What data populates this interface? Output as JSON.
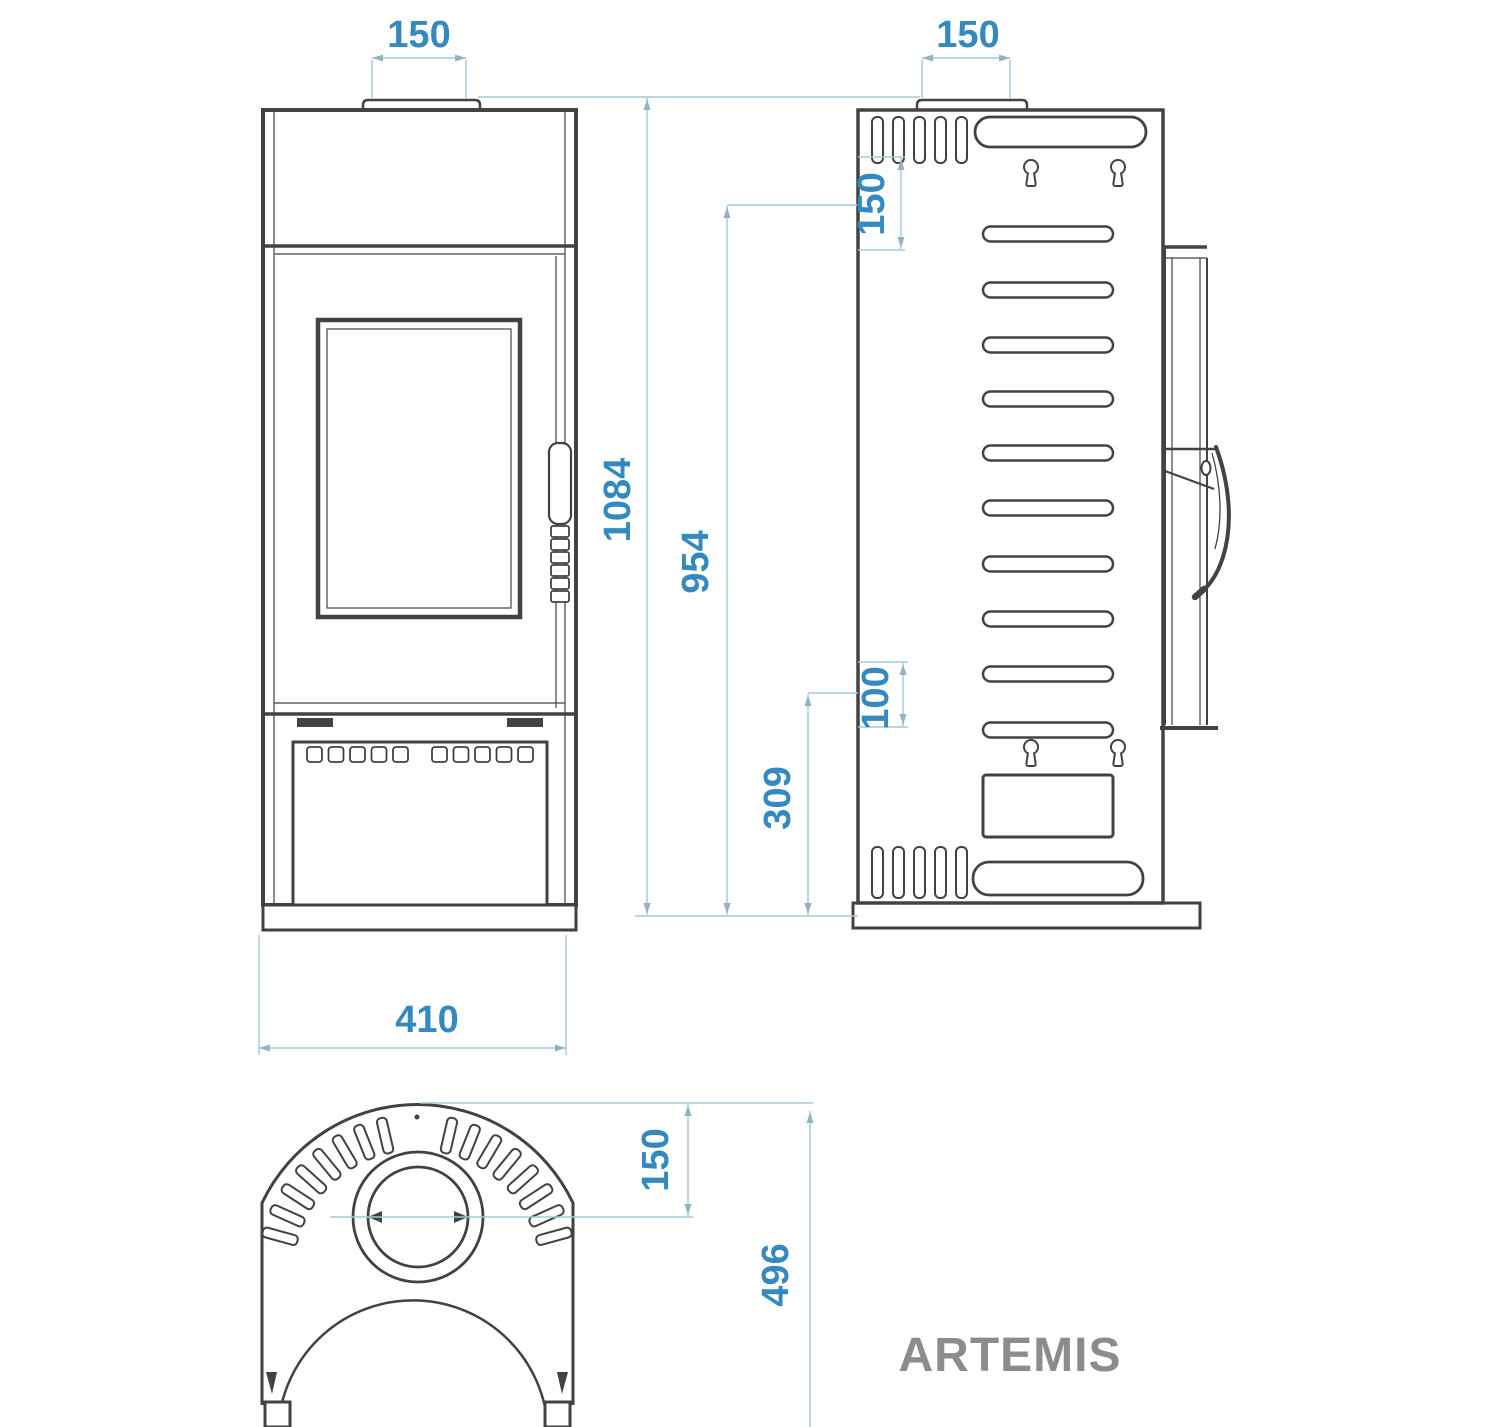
{
  "drawing": {
    "product_name": "ARTEMIS",
    "dimensions": {
      "front_flue_width_mm": "150",
      "rear_flue_width_mm": "150",
      "overall_height_mm": "1084",
      "body_height_mm": "954",
      "rear_outlet_height_mm": "309",
      "rear_outlet_size_mm": "100",
      "rear_flue_offset_mm": "150",
      "overall_width_mm": "410",
      "flue_center_offset_mm": "150",
      "overall_depth_mm": "496"
    },
    "colors": {
      "line": "#424242",
      "dimension_line": "#a6c8d6",
      "dimension_arrow": "#8fb5c5",
      "dimension_text": "#3489c0",
      "title_text": "#8c8c8c"
    }
  }
}
